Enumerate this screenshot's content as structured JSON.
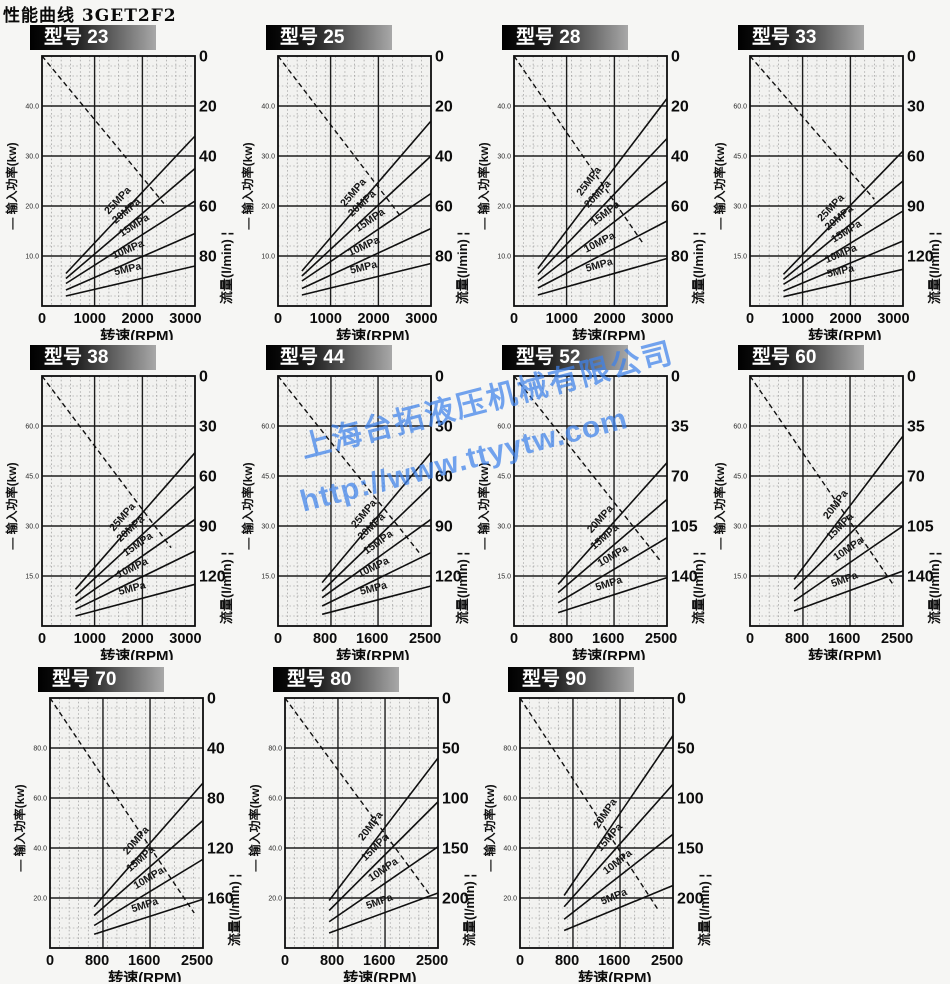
{
  "page_title": "性能曲线  3GET2F2",
  "model_prefix": "型号",
  "axis_labels": {
    "power": "— 输入功率(kw)",
    "flow": "流量(l/min) ¦",
    "speed": "转速(RPM)"
  },
  "watermark": {
    "line1": "上海台拓液压机械有限公司",
    "line2": "http://www.ttyytw.com",
    "color": "#3e82eb"
  },
  "colors": {
    "curve": "#101010",
    "grid_major": "#1c1c1c",
    "grid_minor": "#8d8d8d",
    "plot_bg": "#f2f2f0",
    "badge_text": "#ffffff"
  },
  "chart_data": [
    {
      "type": "line",
      "model": "23",
      "xlabel": "转速(RPM)",
      "x_ticks": [
        0,
        1000,
        2000,
        3000
      ],
      "x_max": 3200,
      "x_major": [
        1100,
        2100
      ],
      "power_tick_labels": [
        "40.0",
        "30.0",
        "20.0",
        "10.0"
      ],
      "power_max": 50,
      "flow_ticks": [
        0,
        20,
        40,
        60,
        80
      ],
      "flow_max": 100,
      "flow_line": [
        [
          0,
          0
        ],
        [
          2550,
          59
        ]
      ],
      "curves": [
        {
          "label": "25MPa",
          "x1": 500,
          "p1": 6.5,
          "x2": 3200,
          "p2": 34,
          "lt": 0.47
        },
        {
          "label": "20MPa",
          "x1": 500,
          "p1": 5.5,
          "x2": 3200,
          "p2": 27.5,
          "lt": 0.53
        },
        {
          "label": "15MPa",
          "x1": 500,
          "p1": 4.5,
          "x2": 3200,
          "p2": 21,
          "lt": 0.58
        },
        {
          "label": "10MPa",
          "x1": 500,
          "p1": 3.2,
          "x2": 3200,
          "p2": 14.5,
          "lt": 0.52
        },
        {
          "label": "5MPa",
          "x1": 500,
          "p1": 2.0,
          "x2": 3200,
          "p2": 8,
          "lt": 0.5
        }
      ]
    },
    {
      "type": "line",
      "model": "25",
      "xlabel": "转速(RPM)",
      "x_ticks": [
        0,
        1000,
        2000,
        3000
      ],
      "x_max": 3200,
      "x_major": [
        1100,
        2100
      ],
      "power_tick_labels": [
        "40.0",
        "30.0",
        "20.0",
        "10.0"
      ],
      "power_max": 50,
      "flow_ticks": [
        0,
        20,
        40,
        60,
        80
      ],
      "flow_max": 100,
      "flow_line": [
        [
          0,
          0
        ],
        [
          2600,
          65
        ]
      ],
      "curves": [
        {
          "label": "25MPa",
          "x1": 500,
          "p1": 7,
          "x2": 3200,
          "p2": 37,
          "lt": 0.47
        },
        {
          "label": "20MPa",
          "x1": 500,
          "p1": 6,
          "x2": 3200,
          "p2": 30,
          "lt": 0.53
        },
        {
          "label": "15MPa",
          "x1": 500,
          "p1": 5,
          "x2": 3200,
          "p2": 22.5,
          "lt": 0.58
        },
        {
          "label": "10MPa",
          "x1": 500,
          "p1": 3.5,
          "x2": 3200,
          "p2": 15.5,
          "lt": 0.52
        },
        {
          "label": "5MPa",
          "x1": 500,
          "p1": 2.2,
          "x2": 3200,
          "p2": 8.5,
          "lt": 0.5
        }
      ]
    },
    {
      "type": "line",
      "model": "28",
      "xlabel": "转速(RPM)",
      "x_ticks": [
        0,
        1000,
        2000,
        3000
      ],
      "x_max": 3200,
      "x_major": [
        1100,
        2100
      ],
      "power_tick_labels": [
        "40.0",
        "30.0",
        "20.0",
        "10.0"
      ],
      "power_max": 50,
      "flow_ticks": [
        0,
        20,
        40,
        60,
        80
      ],
      "flow_max": 100,
      "flow_line": [
        [
          0,
          0
        ],
        [
          2700,
          75
        ]
      ],
      "curves": [
        {
          "label": "25MPa",
          "x1": 500,
          "p1": 7.5,
          "x2": 3200,
          "p2": 41.5,
          "lt": 0.47
        },
        {
          "label": "20MPa",
          "x1": 500,
          "p1": 6.3,
          "x2": 3200,
          "p2": 33.5,
          "lt": 0.53
        },
        {
          "label": "15MPa",
          "x1": 500,
          "p1": 5,
          "x2": 3200,
          "p2": 25,
          "lt": 0.58
        },
        {
          "label": "10MPa",
          "x1": 500,
          "p1": 3.6,
          "x2": 3200,
          "p2": 17,
          "lt": 0.52
        },
        {
          "label": "5MPa",
          "x1": 500,
          "p1": 2.2,
          "x2": 3200,
          "p2": 9.5,
          "lt": 0.5
        }
      ]
    },
    {
      "type": "line",
      "model": "33",
      "xlabel": "转速(RPM)",
      "x_ticks": [
        0,
        1000,
        2000,
        3000
      ],
      "x_max": 3200,
      "x_major": [
        1100,
        2100
      ],
      "power_tick_labels": [
        "60.0",
        "45.0",
        "30.0",
        "15.0"
      ],
      "power_max": 75,
      "flow_ticks": [
        0,
        30,
        60,
        90,
        120
      ],
      "flow_max": 150,
      "flow_line": [
        [
          0,
          0
        ],
        [
          2600,
          86
        ]
      ],
      "curves": [
        {
          "label": "25MPa",
          "x1": 700,
          "p1": 9.5,
          "x2": 3200,
          "p2": 46.5,
          "lt": 0.47
        },
        {
          "label": "20MPa",
          "x1": 700,
          "p1": 8,
          "x2": 3200,
          "p2": 37.5,
          "lt": 0.53
        },
        {
          "label": "15MPa",
          "x1": 700,
          "p1": 6.5,
          "x2": 3200,
          "p2": 28.5,
          "lt": 0.58
        },
        {
          "label": "10MPa",
          "x1": 700,
          "p1": 4.5,
          "x2": 3200,
          "p2": 19.5,
          "lt": 0.52
        },
        {
          "label": "5MPa",
          "x1": 700,
          "p1": 2.8,
          "x2": 3200,
          "p2": 11,
          "lt": 0.5
        }
      ]
    },
    {
      "type": "line",
      "model": "38",
      "xlabel": "转速(RPM)",
      "x_ticks": [
        0,
        1000,
        2000,
        3000
      ],
      "x_max": 3200,
      "x_major": [
        1100,
        2100
      ],
      "power_tick_labels": [
        "60.0",
        "45.0",
        "30.0",
        "15.0"
      ],
      "power_max": 75,
      "flow_ticks": [
        0,
        30,
        60,
        90,
        120
      ],
      "flow_max": 150,
      "flow_line": [
        [
          0,
          0
        ],
        [
          2700,
          103
        ]
      ],
      "curves": [
        {
          "label": "25MPa",
          "x1": 700,
          "p1": 11,
          "x2": 3200,
          "p2": 52,
          "lt": 0.47
        },
        {
          "label": "20MPa",
          "x1": 700,
          "p1": 9,
          "x2": 3200,
          "p2": 42,
          "lt": 0.53
        },
        {
          "label": "15MPa",
          "x1": 700,
          "p1": 7,
          "x2": 3200,
          "p2": 32,
          "lt": 0.58
        },
        {
          "label": "10MPa",
          "x1": 700,
          "p1": 5,
          "x2": 3200,
          "p2": 22.5,
          "lt": 0.52
        },
        {
          "label": "5MPa",
          "x1": 700,
          "p1": 3,
          "x2": 3200,
          "p2": 12.5,
          "lt": 0.5
        }
      ]
    },
    {
      "type": "line",
      "model": "44",
      "xlabel": "转速(RPM)",
      "x_ticks": [
        0,
        800,
        1600,
        2500
      ],
      "x_max": 2600,
      "x_major": [
        900,
        1700
      ],
      "power_tick_labels": [
        "60.0",
        "45.0",
        "30.0",
        "15.0"
      ],
      "power_max": 75,
      "flow_ticks": [
        0,
        30,
        60,
        90,
        120
      ],
      "flow_max": 150,
      "flow_line": [
        [
          0,
          0
        ],
        [
          2400,
          106
        ]
      ],
      "curves": [
        {
          "label": "25MPa",
          "x1": 750,
          "p1": 13,
          "x2": 2600,
          "p2": 52,
          "lt": 0.47
        },
        {
          "label": "20MPa",
          "x1": 750,
          "p1": 10.5,
          "x2": 2600,
          "p2": 42,
          "lt": 0.53
        },
        {
          "label": "15MPa",
          "x1": 750,
          "p1": 8.5,
          "x2": 2600,
          "p2": 32,
          "lt": 0.58
        },
        {
          "label": "10MPa",
          "x1": 750,
          "p1": 6,
          "x2": 2600,
          "p2": 22,
          "lt": 0.52
        },
        {
          "label": "5MPa",
          "x1": 750,
          "p1": 3.5,
          "x2": 2600,
          "p2": 12,
          "lt": 0.5
        }
      ]
    },
    {
      "type": "line",
      "model": "52",
      "xlabel": "转速(RPM)",
      "x_ticks": [
        0,
        800,
        1600,
        2500
      ],
      "x_max": 2600,
      "x_major": [
        900,
        1700
      ],
      "power_tick_labels": [
        "60.0",
        "45.0",
        "30.0",
        "15.0"
      ],
      "power_max": 75,
      "flow_ticks": [
        0,
        35,
        70,
        105,
        140
      ],
      "flow_max": 175,
      "flow_line": [
        [
          0,
          0
        ],
        [
          2500,
          130
        ]
      ],
      "curves": [
        {
          "label": "20MPa",
          "x1": 750,
          "p1": 12.5,
          "x2": 2600,
          "p2": 49,
          "lt": 0.47
        },
        {
          "label": "15MPa",
          "x1": 750,
          "p1": 10,
          "x2": 2600,
          "p2": 38,
          "lt": 0.5
        },
        {
          "label": "10MPa",
          "x1": 750,
          "p1": 7,
          "x2": 2600,
          "p2": 26.5,
          "lt": 0.56
        },
        {
          "label": "5MPa",
          "x1": 750,
          "p1": 4,
          "x2": 2600,
          "p2": 14.5,
          "lt": 0.5
        }
      ]
    },
    {
      "type": "line",
      "model": "60",
      "xlabel": "转速(RPM)",
      "x_ticks": [
        0,
        800,
        1600,
        2500
      ],
      "x_max": 2600,
      "x_major": [
        900,
        1700
      ],
      "power_tick_labels": [
        "60.0",
        "45.0",
        "30.0",
        "15.0"
      ],
      "power_max": 75,
      "flow_ticks": [
        0,
        35,
        70,
        105,
        140
      ],
      "flow_max": 175,
      "flow_line": [
        [
          0,
          0
        ],
        [
          2450,
          147
        ]
      ],
      "curves": [
        {
          "label": "20MPa",
          "x1": 750,
          "p1": 14,
          "x2": 2600,
          "p2": 57,
          "lt": 0.47
        },
        {
          "label": "15MPa",
          "x1": 750,
          "p1": 11,
          "x2": 2600,
          "p2": 43.5,
          "lt": 0.5
        },
        {
          "label": "10MPa",
          "x1": 750,
          "p1": 7.5,
          "x2": 2600,
          "p2": 30,
          "lt": 0.56
        },
        {
          "label": "5MPa",
          "x1": 750,
          "p1": 4.5,
          "x2": 2600,
          "p2": 16.5,
          "lt": 0.5
        }
      ]
    },
    {
      "type": "line",
      "model": "70",
      "xlabel": "转速(RPM)",
      "x_ticks": [
        0,
        800,
        1600,
        2500
      ],
      "x_max": 2600,
      "x_major": [
        900,
        1700
      ],
      "power_tick_labels": [
        "80.0",
        "60.0",
        "40.0",
        "20.0"
      ],
      "power_max": 100,
      "flow_ticks": [
        0,
        40,
        80,
        120,
        160
      ],
      "flow_max": 200,
      "flow_line": [
        [
          0,
          0
        ],
        [
          2450,
          172
        ]
      ],
      "curves": [
        {
          "label": "20MPa",
          "x1": 750,
          "p1": 16.5,
          "x2": 2600,
          "p2": 66,
          "lt": 0.47
        },
        {
          "label": "15MPa",
          "x1": 750,
          "p1": 13,
          "x2": 2600,
          "p2": 51,
          "lt": 0.5
        },
        {
          "label": "10MPa",
          "x1": 750,
          "p1": 9,
          "x2": 2600,
          "p2": 35.5,
          "lt": 0.56
        },
        {
          "label": "5MPa",
          "x1": 750,
          "p1": 5.5,
          "x2": 2600,
          "p2": 19.5,
          "lt": 0.5
        }
      ]
    },
    {
      "type": "line",
      "model": "80",
      "xlabel": "转速(RPM)",
      "x_ticks": [
        0,
        800,
        1600,
        2500
      ],
      "x_max": 2600,
      "x_major": [
        900,
        1700
      ],
      "power_tick_labels": [
        "80.0",
        "60.0",
        "40.0",
        "20.0"
      ],
      "power_max": 100,
      "flow_ticks": [
        0,
        50,
        100,
        150,
        200
      ],
      "flow_max": 250,
      "flow_line": [
        [
          0,
          0
        ],
        [
          2450,
          196
        ]
      ],
      "curves": [
        {
          "label": "20MPa",
          "x1": 750,
          "p1": 19,
          "x2": 2600,
          "p2": 76,
          "lt": 0.47
        },
        {
          "label": "15MPa",
          "x1": 750,
          "p1": 15,
          "x2": 2600,
          "p2": 58.5,
          "lt": 0.5
        },
        {
          "label": "10MPa",
          "x1": 750,
          "p1": 10.5,
          "x2": 2600,
          "p2": 40.5,
          "lt": 0.56
        },
        {
          "label": "5MPa",
          "x1": 750,
          "p1": 6,
          "x2": 2600,
          "p2": 22,
          "lt": 0.5
        }
      ]
    },
    {
      "type": "line",
      "model": "90",
      "xlabel": "转速(RPM)",
      "x_ticks": [
        0,
        800,
        1600,
        2500
      ],
      "x_max": 2600,
      "x_major": [
        900,
        1700
      ],
      "power_tick_labels": [
        "80.0",
        "60.0",
        "40.0",
        "20.0"
      ],
      "power_max": 100,
      "flow_ticks": [
        0,
        50,
        100,
        150,
        200
      ],
      "flow_max": 250,
      "flow_line": [
        [
          0,
          0
        ],
        [
          2350,
          212
        ]
      ],
      "curves": [
        {
          "label": "20MPa",
          "x1": 750,
          "p1": 21,
          "x2": 2600,
          "p2": 85,
          "lt": 0.47
        },
        {
          "label": "15MPa",
          "x1": 750,
          "p1": 16.5,
          "x2": 2600,
          "p2": 65.5,
          "lt": 0.5
        },
        {
          "label": "10MPa",
          "x1": 750,
          "p1": 11.5,
          "x2": 2600,
          "p2": 45.5,
          "lt": 0.56
        },
        {
          "label": "5MPa",
          "x1": 750,
          "p1": 7,
          "x2": 2600,
          "p2": 25,
          "lt": 0.5
        }
      ]
    }
  ]
}
